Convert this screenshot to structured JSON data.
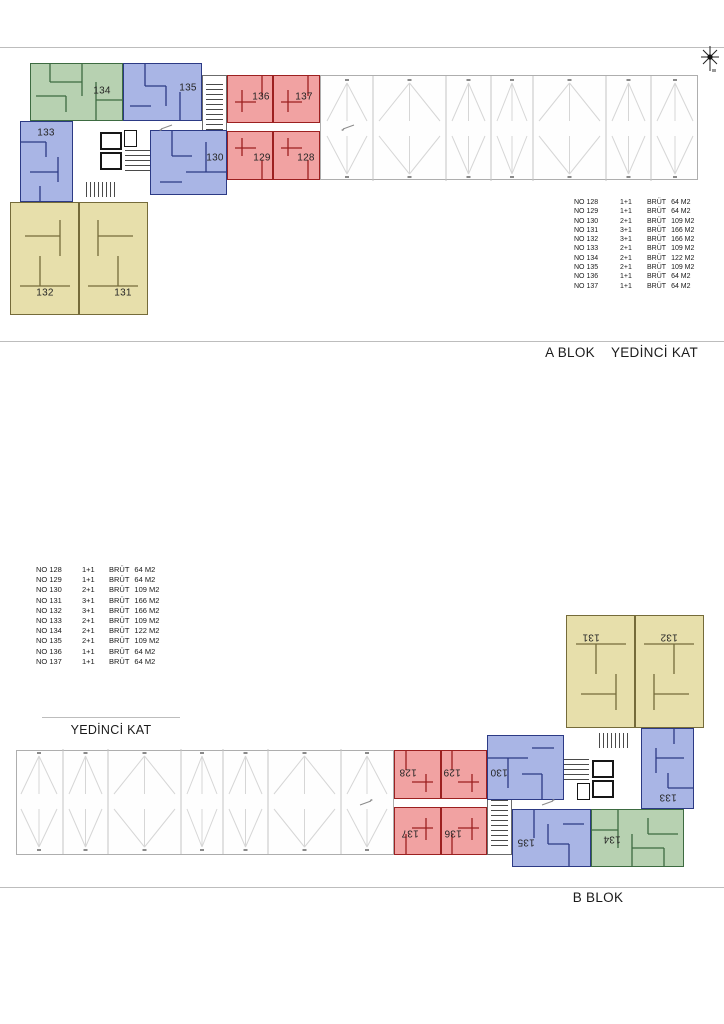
{
  "captions": {
    "a_blok": "A BLOK",
    "floor": "YEDİNCİ KAT",
    "b_blok": "B BLOK"
  },
  "unit_table": {
    "brut_label": "BRÜT",
    "rows": [
      {
        "no": "NO 128",
        "type": "1+1",
        "area": "64 M2"
      },
      {
        "no": "NO 129",
        "type": "1+1",
        "area": "64 M2"
      },
      {
        "no": "NO 130",
        "type": "2+1",
        "area": "109 M2"
      },
      {
        "no": "NO 131",
        "type": "3+1",
        "area": "166 M2"
      },
      {
        "no": "NO 132",
        "type": "3+1",
        "area": "166 M2"
      },
      {
        "no": "NO 133",
        "type": "2+1",
        "area": "109 M2"
      },
      {
        "no": "NO 134",
        "type": "2+1",
        "area": "122 M2"
      },
      {
        "no": "NO 135",
        "type": "2+1",
        "area": "109 M2"
      },
      {
        "no": "NO 136",
        "type": "1+1",
        "area": "64 M2"
      },
      {
        "no": "NO 137",
        "type": "1+1",
        "area": "64 M2"
      }
    ]
  },
  "plan": {
    "units": [
      {
        "no": "134",
        "color": "green"
      },
      {
        "no": "135",
        "color": "blue"
      },
      {
        "no": "136",
        "color": "red"
      },
      {
        "no": "137",
        "color": "red"
      },
      {
        "no": "133",
        "color": "blue"
      },
      {
        "no": "130",
        "color": "blue"
      },
      {
        "no": "129",
        "color": "red"
      },
      {
        "no": "128",
        "color": "red"
      },
      {
        "no": "132",
        "color": "yellow"
      },
      {
        "no": "131",
        "color": "yellow"
      }
    ]
  },
  "colors": {
    "green_fill": "#b7d1b1",
    "green_line": "#3d6b41",
    "blue_fill": "#a9b5e5",
    "blue_line": "#2c3a85",
    "red_fill": "#f1a2a2",
    "red_line": "#9c2020",
    "yellow_fill": "#e7dfab",
    "yellow_line": "#756b3a"
  }
}
